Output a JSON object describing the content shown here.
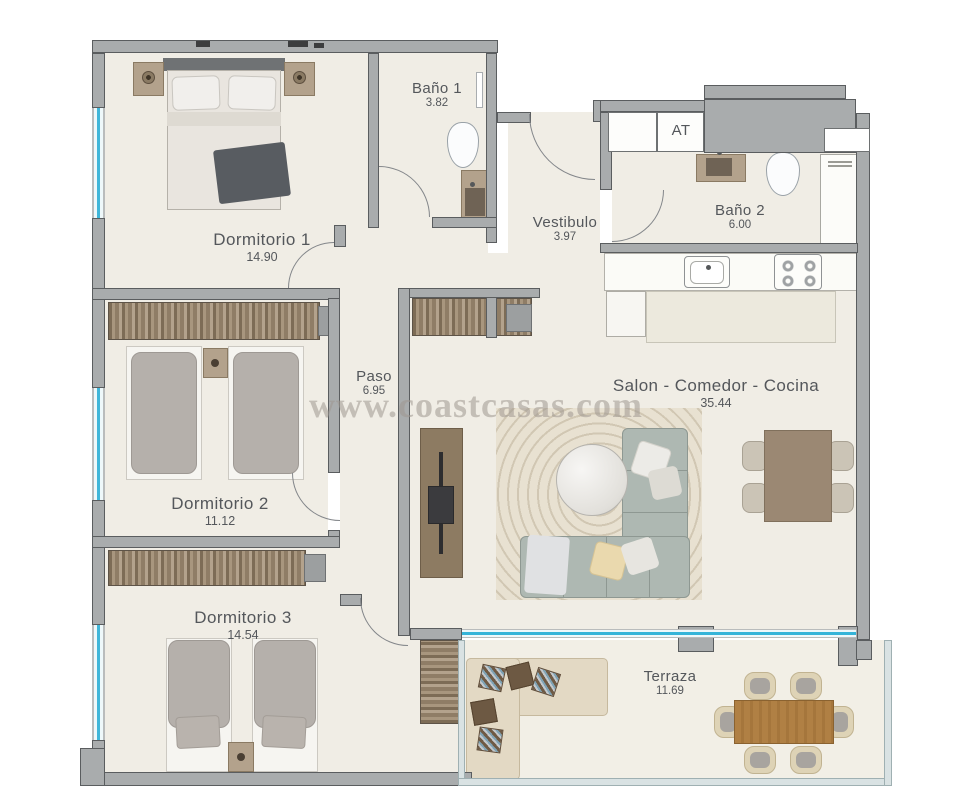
{
  "watermark": "www.coastcasas.com",
  "rooms": [
    {
      "name": "Dormitorio 1",
      "area": "14.90"
    },
    {
      "name": "Baño 1",
      "area": "3.82"
    },
    {
      "name": "Vestibulo",
      "area": "3.97"
    },
    {
      "name": "AT",
      "area": ""
    },
    {
      "name": "Baño 2",
      "area": "6.00"
    },
    {
      "name": "Paso",
      "area": "6.95"
    },
    {
      "name": "Salon - Comedor - Cocina",
      "area": "35.44"
    },
    {
      "name": "Dormitorio 2",
      "area": "11.12"
    },
    {
      "name": "Dormitorio 3",
      "area": "14.54"
    },
    {
      "name": "Terraza",
      "area": "11.69"
    }
  ],
  "colors": {
    "wall": "#a9acad",
    "window_glazing": "#3fb6d9",
    "floor": "#f0ede5",
    "terrace_frame": "#d9e2e3",
    "label_text": "#54575b"
  }
}
